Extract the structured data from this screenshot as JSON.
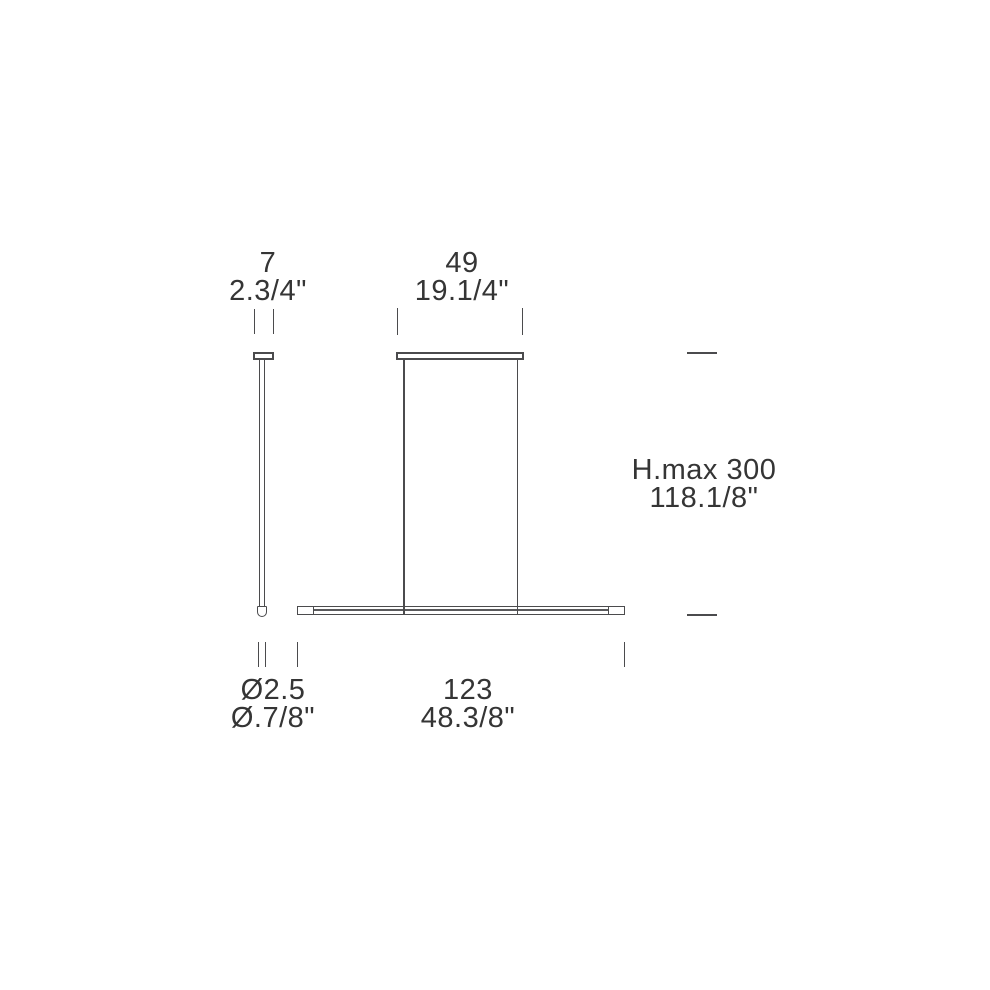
{
  "page": {
    "title": "Linear pendant lamp dimension drawing",
    "background": "#ffffff"
  },
  "colors": {
    "line": "#4b4b4d",
    "text": "#353535"
  },
  "labels": {
    "canopy_side_width": {
      "metric": "7",
      "imperial": "2.3/4\""
    },
    "canopy_front_width": {
      "metric": "49",
      "imperial": "19.1/4\""
    },
    "max_height": {
      "metric": "H.max 300",
      "imperial": "118.1/8\""
    },
    "stem_diameter": {
      "metric": "Ø2.5",
      "imperial": "Ø.7/8\""
    },
    "bar_length": {
      "metric": "123",
      "imperial": "48.3/8\""
    }
  }
}
